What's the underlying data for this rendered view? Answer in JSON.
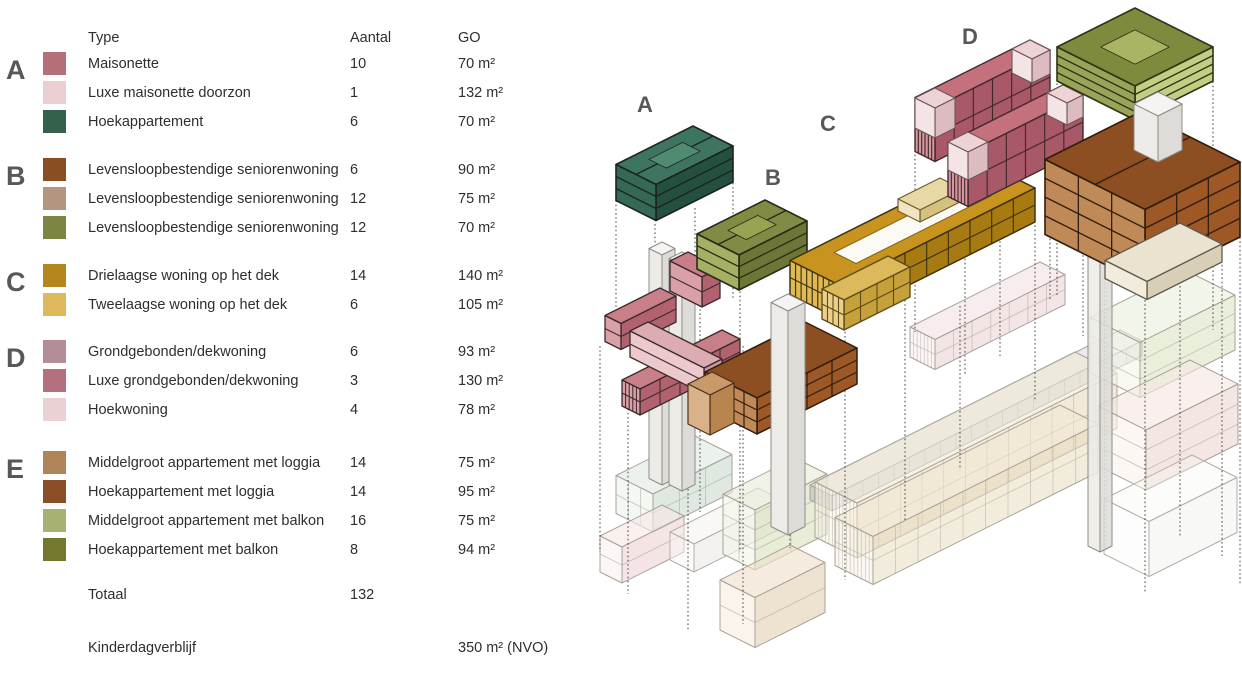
{
  "legend": {
    "header": {
      "type": "Type",
      "aantal": "Aantal",
      "go": "GO"
    },
    "groups": [
      {
        "letter": "A",
        "rows": [
          {
            "color": "#b47079",
            "type": "Maisonette",
            "aantal": "10",
            "go": "70 m²"
          },
          {
            "color": "#eaced2",
            "type": "Luxe maisonette doorzon",
            "aantal": "1",
            "go": "132 m²"
          },
          {
            "color": "#35604c",
            "type": "Hoekappartement",
            "aantal": "6",
            "go": "70 m²"
          }
        ]
      },
      {
        "letter": "B",
        "rows": [
          {
            "color": "#8a4e25",
            "type": "Levensloopbestendige seniorenwoning",
            "aantal": "6",
            "go": "90 m²"
          },
          {
            "color": "#b29680",
            "type": "Levensloopbestendige seniorenwoning",
            "aantal": "12",
            "go": "75 m²"
          },
          {
            "color": "#7d8545",
            "type": "Levensloopbestendige seniorenwoning",
            "aantal": "12",
            "go": "70 m²"
          }
        ]
      },
      {
        "letter": "C",
        "rows": [
          {
            "color": "#b4871e",
            "type": "Drielaagse woning op het dek",
            "aantal": "14",
            "go": "140 m²"
          },
          {
            "color": "#dcb95a",
            "type": "Tweelaagse woning op het dek",
            "aantal": "6",
            "go": "105 m²"
          }
        ]
      },
      {
        "letter": "D",
        "rows": [
          {
            "color": "#b58d98",
            "type": "Grondgebonden/dekwoning",
            "aantal": "6",
            "go": "93 m²"
          },
          {
            "color": "#b4707c",
            "type": "Luxe grondgebonden/dekwoning",
            "aantal": "3",
            "go": "130 m²"
          },
          {
            "color": "#ecd1d4",
            "type": "Hoekwoning",
            "aantal": "4",
            "go": "78 m²"
          }
        ]
      },
      {
        "letter": "E",
        "rows": [
          {
            "color": "#af8458",
            "type": "Middelgroot appartement met loggia",
            "aantal": "14",
            "go": "75 m²"
          },
          {
            "color": "#8b4e26",
            "type": "Hoekappartement met loggia",
            "aantal": "14",
            "go": "95 m²"
          },
          {
            "color": "#a6b172",
            "type": "Middelgroot appartement met balkon",
            "aantal": "16",
            "go": "75 m²"
          },
          {
            "color": "#74772e",
            "type": "Hoekappartement met balkon",
            "aantal": "8",
            "go": "94 m²"
          }
        ]
      }
    ],
    "totals": {
      "label": "Totaal",
      "aantal": "132"
    },
    "extra": {
      "label": "Kinderdagverblijf",
      "go": "350 m² (NVO)"
    }
  },
  "diagram": {
    "labels": [
      "A",
      "B",
      "C",
      "D"
    ],
    "palette": {
      "green_a": "#35604c",
      "olive_b": "#7d8545",
      "gold_c": "#b4871e",
      "gold_light_c": "#dcb95a",
      "rose_d": "#b4707c",
      "pink_light": "#ecd1d4",
      "brown_e": "#8b4e26",
      "sage_e": "#a6b172",
      "label_gray": "#57585a"
    }
  }
}
